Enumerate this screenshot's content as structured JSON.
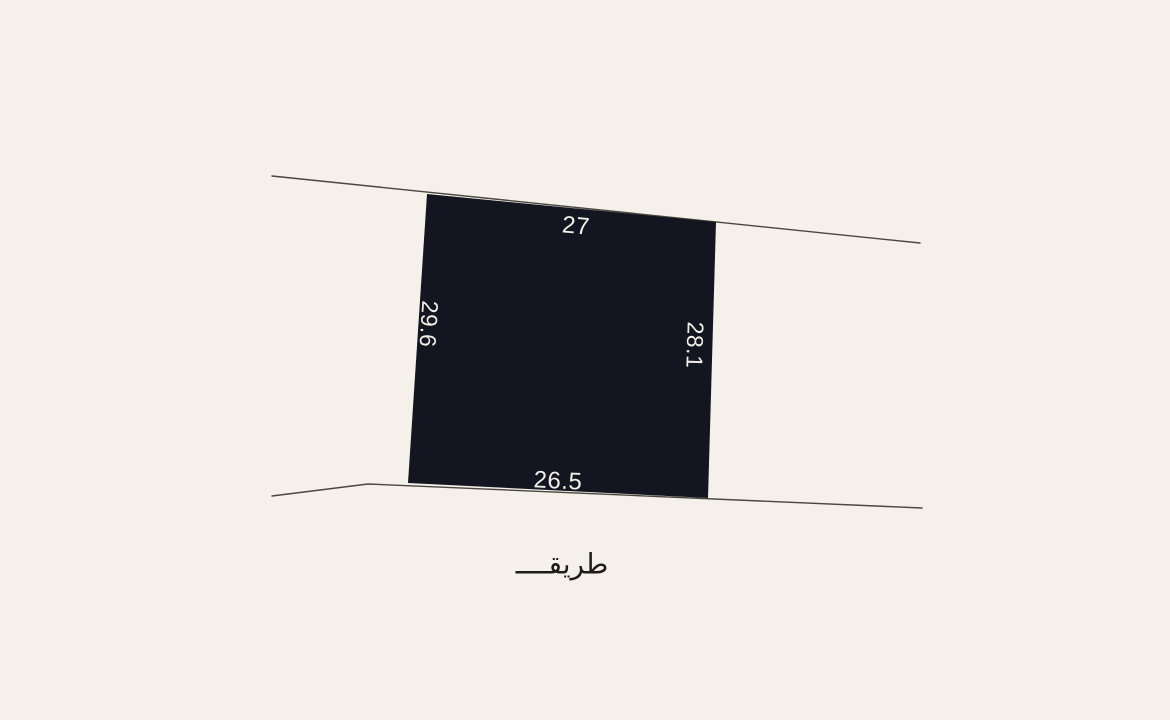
{
  "canvas": {
    "width": 1170,
    "height": 720,
    "background": "#F5F0E9"
  },
  "parcel": {
    "fill": "#131621",
    "dimension_text_color": "#F2EFE7",
    "dimensions": {
      "top": "27",
      "left": "29.6",
      "right": "28.1",
      "bottom": "26.5"
    }
  },
  "road": {
    "label": "طريقــــ",
    "text_color": "#1E1C19",
    "line_color": "#4A463E"
  }
}
